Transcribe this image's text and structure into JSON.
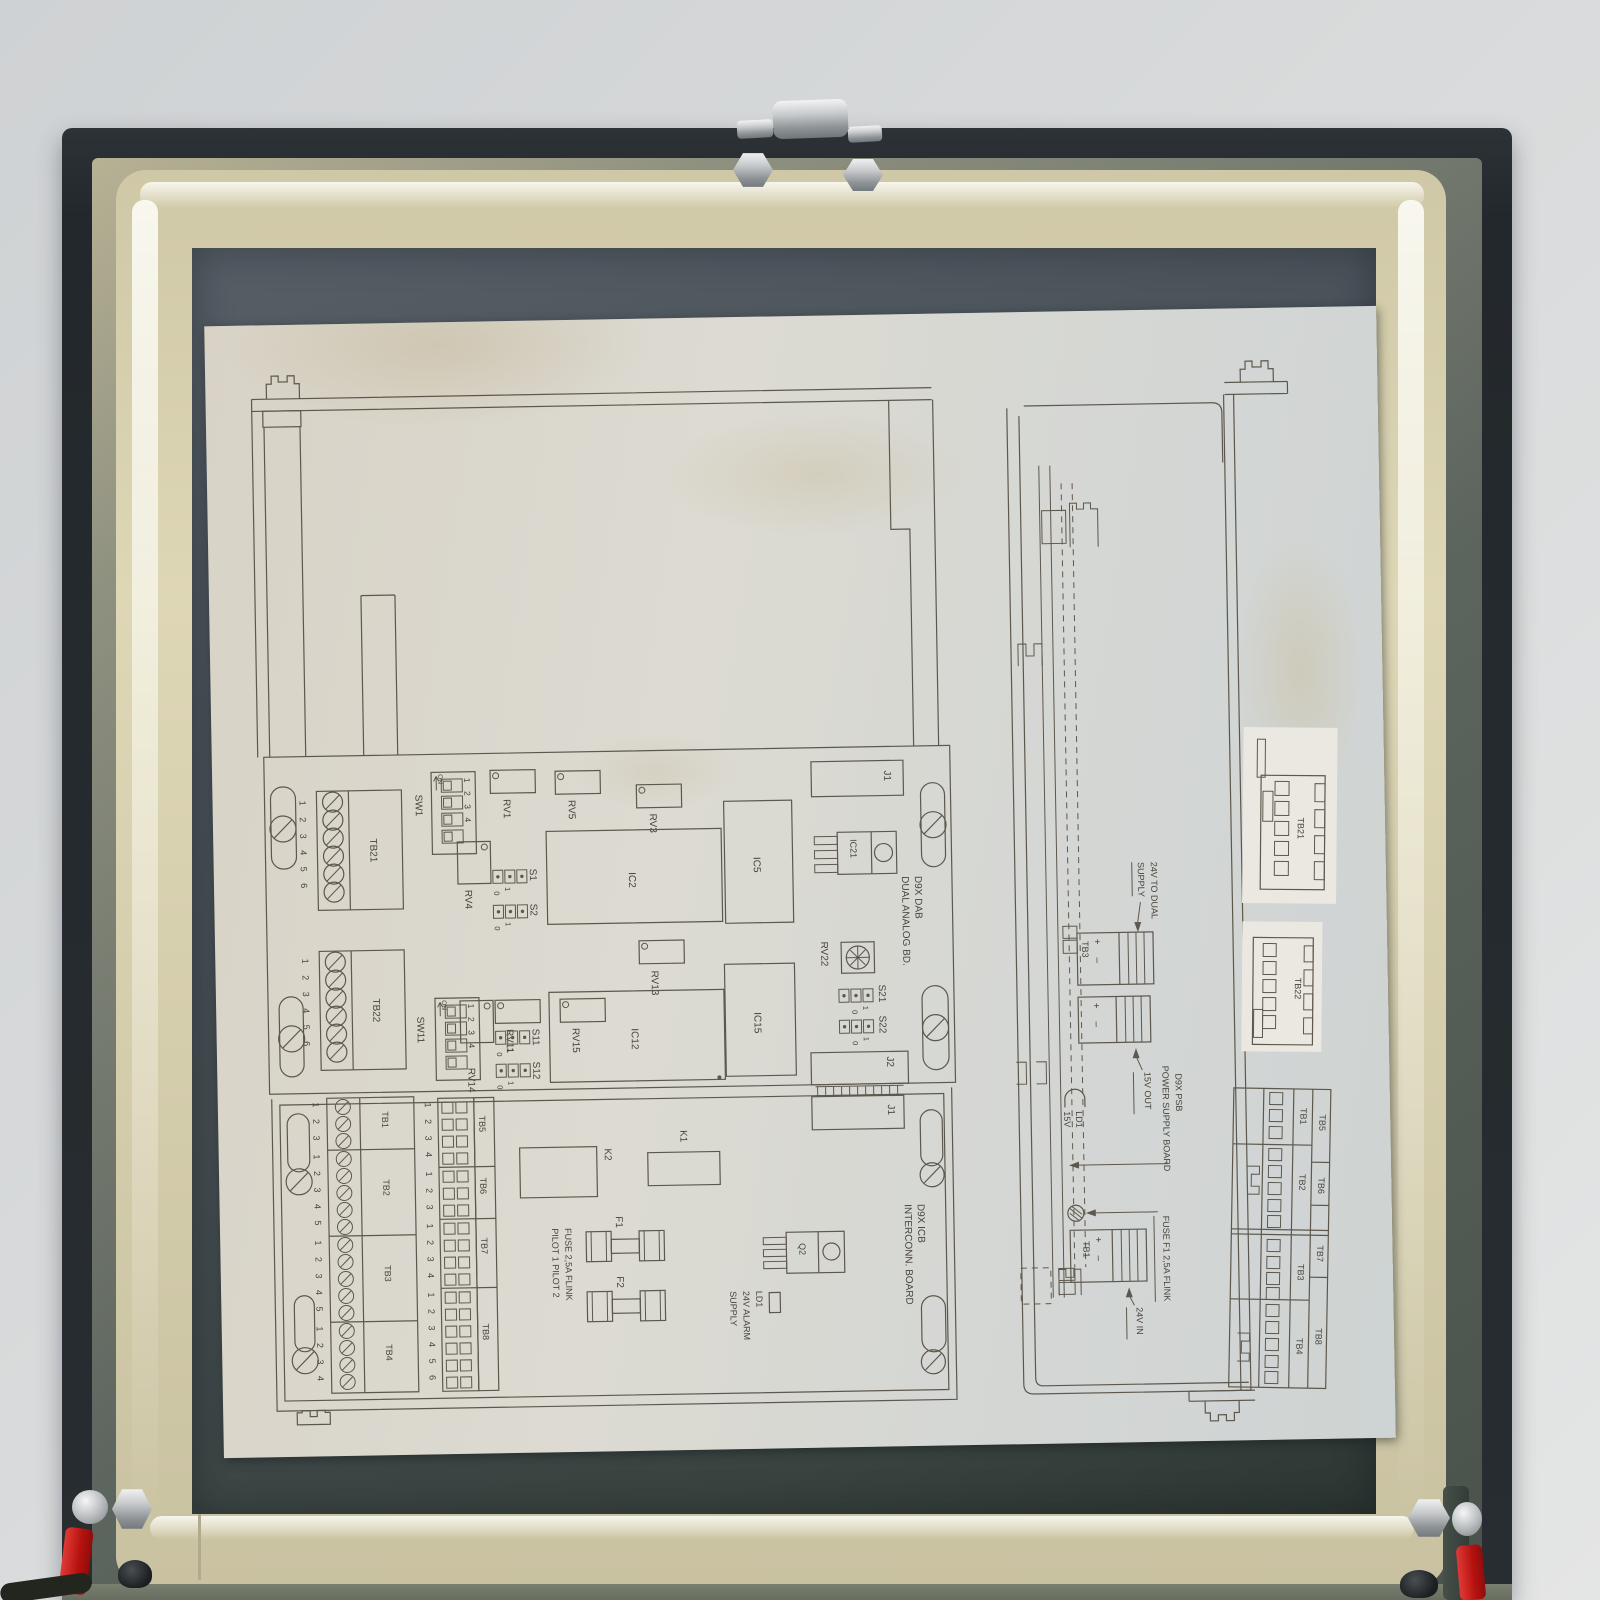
{
  "scene": {
    "object": "open-equipment-lid-with-board-layout-diagram",
    "colors": {
      "wall_grey": "#d8dadb",
      "lid_dark": "#262b2f",
      "gasket_cream": "#dbd4b2",
      "panel_slate": "#49515a",
      "paper": "#d9d6cf",
      "line_ink": "#5d584d",
      "metal_silver": "#c3c6c8",
      "accent_red": "#c71a1f"
    }
  },
  "dab": {
    "title1": "D9X DAB",
    "title2": "DUAL ANALOG BD.",
    "tb21": "TB21",
    "tb22": "TB22",
    "tb21_pins": "123456",
    "tb22_pins": "123456",
    "sw1": "SW1",
    "sw11": "SW11",
    "dip_digits": "1234",
    "dip_on": "ON",
    "rv1": "RV1",
    "rv3": "RV3",
    "rv4": "RV4",
    "rv5": "RV5",
    "rv11": "RV11",
    "rv13": "RV13",
    "rv14": "RV14",
    "rv15": "RV15",
    "rv22": "RV22",
    "ic2": "IC2",
    "ic5": "IC5",
    "ic12": "IC12",
    "ic15": "IC15",
    "ic21": "IC21",
    "s1": "S1",
    "s2": "S2",
    "s11": "S11",
    "s12": "S12",
    "s21": "S21",
    "s22": "S22",
    "j1": "J1",
    "j2": "J2",
    "one": "1",
    "zero": "0"
  },
  "icb": {
    "title1": "D9X ICB",
    "title2": "INTERCONN. BOARD",
    "j1": "J1",
    "k1": "K1",
    "k2": "K2",
    "f1": "F1",
    "f2": "F2",
    "q2": "Q2",
    "fuse_note": "FUSE 2,5A FLINK",
    "pilot_note": "PILOT 1  PILOT 2",
    "ld1_note1": "LD1",
    "ld1_note2": "24V ALARM",
    "ld1_note3": "SUPPLY",
    "tb1": "TB1",
    "tb2": "TB2",
    "tb3": "TB3",
    "tb4": "TB4",
    "tb5": "TB5",
    "tb6": "TB6",
    "tb7": "TB7",
    "tb8": "TB8",
    "tb1_pins": "123",
    "tb2_pins": "12345",
    "tb3_pins": "12345",
    "tb4_pins": "1234",
    "tb5_pins": "1234",
    "tb6_pins": "123",
    "tb7_pins": "1234",
    "tb8_pins": "123456"
  },
  "psu": {
    "note24_1": "24V TO DUAL",
    "note24_2": "SUPPLY",
    "tb3": "TB3",
    "plus_minus": "+ –",
    "out15": "15V OUT",
    "title1": "D9X PSB",
    "title2": "POWER SUPPLY BOARD",
    "ld1": "LD1",
    "v15": "15V",
    "fuse_note": "FUSE F1 2,5A FLINK",
    "tb1": "TB1",
    "in24": "24V IN",
    "det_tb21": "TB21",
    "det_tb22": "TB22",
    "stk_tb1": "TB1",
    "stk_tb2": "TB2",
    "stk_tb3": "TB3",
    "stk_tb4": "TB4",
    "stk_tb5": "TB5",
    "stk_tb6": "TB6",
    "stk_tb7": "TB7",
    "stk_tb8": "TB8"
  }
}
